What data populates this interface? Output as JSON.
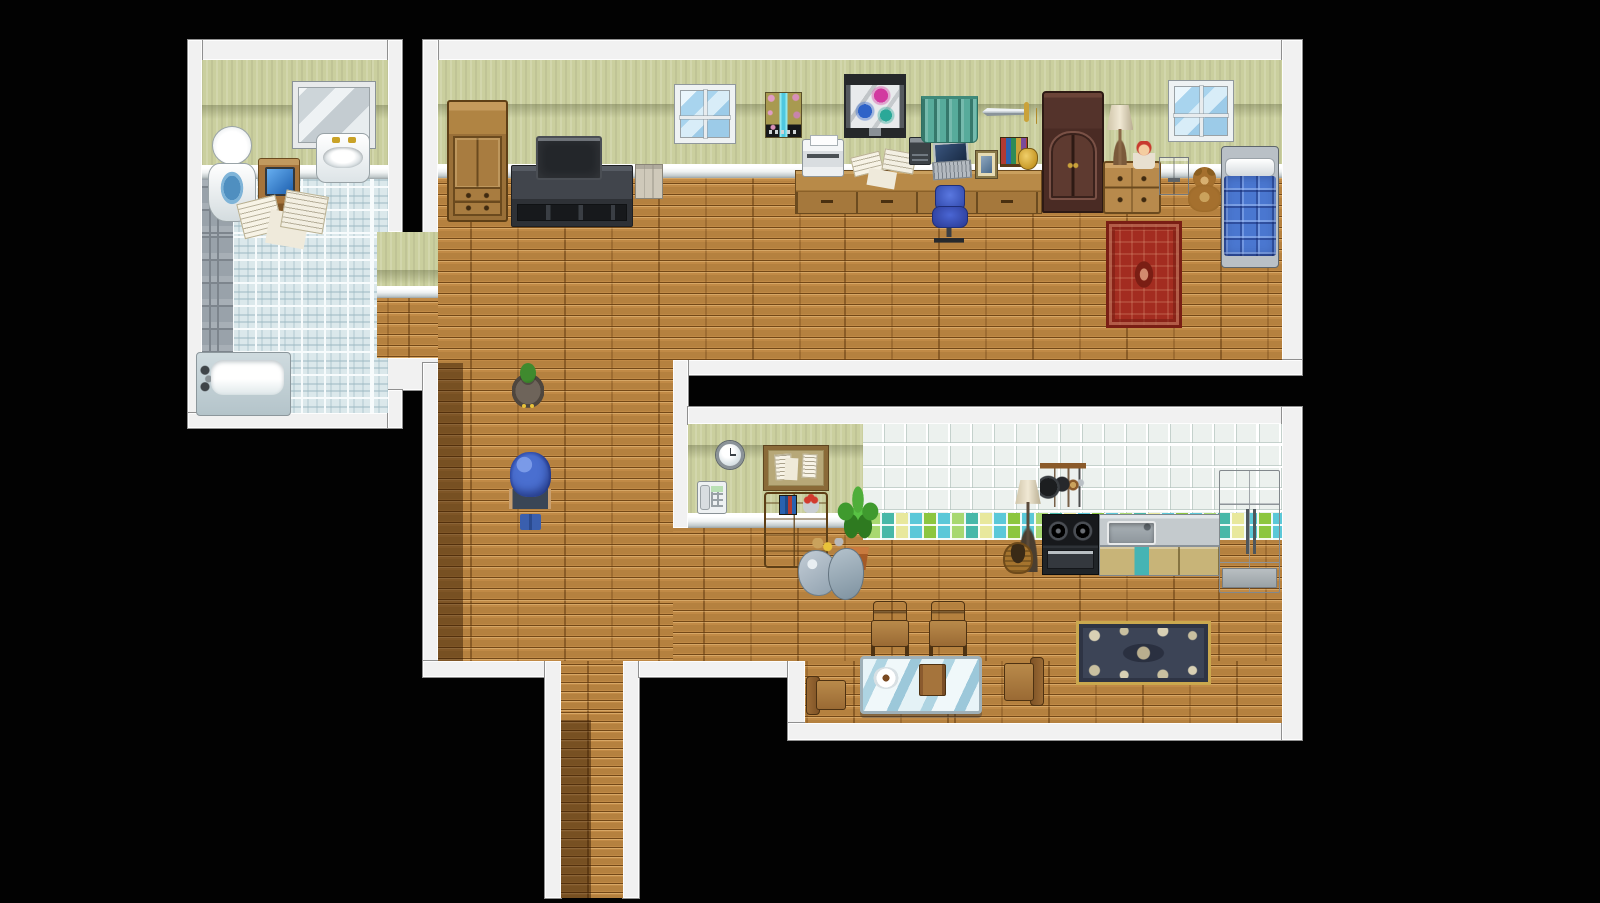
{
  "meta": {
    "app": "rpg-maker-style-game",
    "scene": "top-down house interior map",
    "viewport": {
      "width": 1600,
      "height": 903
    },
    "background_color": "#020202"
  },
  "palette": {
    "wall_border": "#f1f1f1",
    "wallpaper_green": "#cacf9e",
    "wood_floor": "#b5813f",
    "bathroom_tile": "#dbe8eb",
    "gray_tile": "#99a2aa",
    "kitchen_tile": "#ecf1ee",
    "quilt_blue": "#4a77d0",
    "rug_red": "#a32c20",
    "rug_dark": "#3c4456",
    "curtain_teal": "#57ab9b",
    "shadow": "rgba(45,20,0,0.45)"
  },
  "rooms": [
    {
      "name": "bathroom",
      "position": "top-left"
    },
    {
      "name": "bedroom-study",
      "position": "top"
    },
    {
      "name": "kitchen-dining",
      "position": "bottom-right"
    },
    {
      "name": "hallway",
      "position": "center-left"
    },
    {
      "name": "corridor-exit",
      "position": "bottom"
    }
  ],
  "map": {
    "borders": [
      {
        "name": "bathroom-wall-top",
        "x": 188,
        "y": 40,
        "w": 214,
        "h": 20
      },
      {
        "name": "bathroom-wall-left",
        "x": 188,
        "y": 40,
        "w": 14,
        "h": 388
      },
      {
        "name": "bathroom-wall-right-upper",
        "x": 388,
        "y": 40,
        "w": 14,
        "h": 192
      },
      {
        "name": "bathroom-wall-bottom",
        "x": 188,
        "y": 413,
        "w": 214,
        "h": 15
      },
      {
        "name": "bedroom-wall-top",
        "x": 423,
        "y": 40,
        "w": 879,
        "h": 20
      },
      {
        "name": "bedroom-wall-left-upper",
        "x": 423,
        "y": 40,
        "w": 15,
        "h": 258
      },
      {
        "name": "bedroom-wall-right",
        "x": 1282,
        "y": 40,
        "w": 20,
        "h": 335
      },
      {
        "name": "bedroom-wall-bottom",
        "x": 673,
        "y": 360,
        "w": 629,
        "h": 15
      },
      {
        "name": "kitchen-wall-left-cap",
        "x": 673,
        "y": 360,
        "w": 15,
        "h": 168
      },
      {
        "name": "passage-wall-band",
        "x": 380,
        "y": 358,
        "w": 60,
        "h": 32
      },
      {
        "name": "passage-wall-band-lower",
        "x": 388,
        "y": 390,
        "w": 14,
        "h": 38
      },
      {
        "name": "hallway-wall-left",
        "x": 423,
        "y": 363,
        "w": 15,
        "h": 314
      },
      {
        "name": "hallway-wall-bottom",
        "x": 423,
        "y": 661,
        "w": 122,
        "h": 16
      },
      {
        "name": "corridor-wall-left",
        "x": 545,
        "y": 661,
        "w": 16,
        "h": 237
      },
      {
        "name": "corridor-wall-right",
        "x": 623,
        "y": 661,
        "w": 16,
        "h": 237
      },
      {
        "name": "mid-wall-bottom-band",
        "x": 639,
        "y": 661,
        "w": 149,
        "h": 16
      },
      {
        "name": "kitchen-wall-left-lower",
        "x": 788,
        "y": 661,
        "w": 17,
        "h": 62
      },
      {
        "name": "kitchen-wall-bottom",
        "x": 788,
        "y": 723,
        "w": 514,
        "h": 17
      },
      {
        "name": "kitchen-wall-top",
        "x": 688,
        "y": 407,
        "w": 614,
        "h": 17
      },
      {
        "name": "kitchen-wall-right",
        "x": 1282,
        "y": 407,
        "w": 20,
        "h": 333
      }
    ],
    "surfaces": [
      {
        "name": "bathroom-wallpaper",
        "kind": "wallpaper",
        "x": 202,
        "y": 60,
        "w": 186,
        "h": 105
      },
      {
        "name": "bathroom-wall-trim",
        "kind": "trim",
        "x": 202,
        "y": 165,
        "w": 186,
        "h": 14
      },
      {
        "name": "bathroom-floor",
        "kind": "floor-tile",
        "x": 202,
        "y": 179,
        "w": 186,
        "h": 234
      },
      {
        "name": "bathroom-floor-gray-strip",
        "kind": "floor-gray",
        "x": 202,
        "y": 179,
        "w": 31,
        "h": 234
      },
      {
        "name": "passage-wallpaper",
        "kind": "wallpaper",
        "x": 377,
        "y": 232,
        "w": 68,
        "h": 54
      },
      {
        "name": "passage-wall-trim",
        "kind": "trim",
        "x": 377,
        "y": 286,
        "w": 68,
        "h": 12
      },
      {
        "name": "passage-floor",
        "kind": "floor-wood",
        "x": 377,
        "y": 298,
        "w": 68,
        "h": 60
      },
      {
        "name": "bedroom-wallpaper",
        "kind": "wallpaper",
        "x": 438,
        "y": 60,
        "w": 844,
        "h": 104
      },
      {
        "name": "bedroom-wall-trim",
        "kind": "trim",
        "x": 438,
        "y": 164,
        "w": 844,
        "h": 14
      },
      {
        "name": "bedroom-floor",
        "kind": "floor-wood",
        "x": 438,
        "y": 178,
        "w": 844,
        "h": 182
      },
      {
        "name": "hallway-floor",
        "kind": "floor-wood",
        "x": 438,
        "y": 360,
        "w": 235,
        "h": 301
      },
      {
        "name": "kitchen-wallpaper-green",
        "kind": "wallpaper",
        "x": 688,
        "y": 424,
        "w": 175,
        "h": 89
      },
      {
        "name": "kitchen-wall-tiles",
        "kind": "wall-tile",
        "x": 863,
        "y": 424,
        "w": 419,
        "h": 89
      },
      {
        "name": "kitchen-wall-trim",
        "kind": "trim",
        "x": 688,
        "y": 513,
        "w": 175,
        "h": 15
      },
      {
        "name": "kitchen-floor",
        "kind": "floor-wood",
        "x": 673,
        "y": 528,
        "w": 609,
        "h": 133
      },
      {
        "name": "kitchen-backsplash",
        "kind": "backsplash",
        "x": 863,
        "y": 513,
        "w": 419,
        "h": 27
      },
      {
        "name": "kitchen-floor-lower",
        "kind": "floor-wood",
        "x": 805,
        "y": 661,
        "w": 477,
        "h": 62
      },
      {
        "name": "corridor-floor",
        "kind": "floor-corridor",
        "x": 561,
        "y": 661,
        "w": 62,
        "h": 237
      }
    ],
    "shadows": [
      {
        "name": "hallway-wall-shadow",
        "x": 438,
        "y": 363,
        "w": 25,
        "h": 298
      },
      {
        "name": "corridor-wall-shadow",
        "x": 561,
        "y": 720,
        "w": 30,
        "h": 178
      }
    ],
    "furniture": [
      {
        "name": "bathroom-mirror",
        "kind": "mirror",
        "x": 293,
        "y": 82,
        "w": 82,
        "h": 66
      },
      {
        "name": "bathroom-sink",
        "kind": "sink",
        "x": 316,
        "y": 133,
        "w": 54,
        "h": 50
      },
      {
        "name": "toilet",
        "kind": "toilet",
        "x": 208,
        "y": 126,
        "w": 46,
        "h": 98
      },
      {
        "name": "bathroom-stand",
        "kind": "bath-stand",
        "x": 258,
        "y": 158,
        "w": 42,
        "h": 54
      },
      {
        "name": "scattered-magazines",
        "kind": "papers",
        "x": 240,
        "y": 193,
        "w": 90,
        "h": 58
      },
      {
        "name": "bathtub",
        "kind": "bathtub",
        "x": 196,
        "y": 352,
        "w": 95,
        "h": 64
      },
      {
        "name": "wardrobe",
        "kind": "wardrobe",
        "x": 447,
        "y": 100,
        "w": 61,
        "h": 122
      },
      {
        "name": "tv-stand",
        "kind": "tv-stand",
        "x": 511,
        "y": 165,
        "w": 122,
        "h": 62
      },
      {
        "name": "television",
        "kind": "tv",
        "x": 536,
        "y": 136,
        "w": 66,
        "h": 44
      },
      {
        "name": "file-organizer",
        "kind": "file-box",
        "x": 635,
        "y": 164,
        "w": 28,
        "h": 35
      },
      {
        "name": "window-bedroom-left",
        "kind": "window",
        "x": 675,
        "y": 85,
        "w": 60,
        "h": 58
      },
      {
        "name": "wall-poster",
        "kind": "poster",
        "x": 765,
        "y": 92,
        "w": 37,
        "h": 46
      },
      {
        "name": "study-desk",
        "kind": "desk",
        "x": 795,
        "y": 170,
        "w": 247,
        "h": 44
      },
      {
        "name": "printer",
        "kind": "printer",
        "x": 802,
        "y": 139,
        "w": 42,
        "h": 38
      },
      {
        "name": "scattered-papers-desk",
        "kind": "papers",
        "x": 852,
        "y": 151,
        "w": 66,
        "h": 31
      },
      {
        "name": "typewriter",
        "kind": "typewriter",
        "x": 909,
        "y": 137,
        "w": 22,
        "h": 28
      },
      {
        "name": "laptop",
        "kind": "laptop",
        "x": 932,
        "y": 142,
        "w": 39,
        "h": 39
      },
      {
        "name": "photo-frame",
        "kind": "photo-frame",
        "x": 976,
        "y": 151,
        "w": 21,
        "h": 27
      },
      {
        "name": "desk-books",
        "kind": "books",
        "x": 1000,
        "y": 137,
        "w": 28,
        "h": 30
      },
      {
        "name": "gold-jug",
        "kind": "gold-jug",
        "x": 1018,
        "y": 148,
        "w": 20,
        "h": 22
      },
      {
        "name": "butterfly-picture",
        "kind": "picture",
        "x": 846,
        "y": 76,
        "w": 58,
        "h": 60
      },
      {
        "name": "green-curtain",
        "kind": "curtain",
        "x": 921,
        "y": 96,
        "w": 57,
        "h": 47
      },
      {
        "name": "wall-sword",
        "kind": "sword",
        "x": 982,
        "y": 102,
        "w": 60,
        "h": 20
      },
      {
        "name": "dark-armoire",
        "kind": "armoire",
        "x": 1042,
        "y": 91,
        "w": 62,
        "h": 122
      },
      {
        "name": "dresser",
        "kind": "dresser",
        "x": 1103,
        "y": 161,
        "w": 58,
        "h": 53
      },
      {
        "name": "table-lamp",
        "kind": "table-lamp",
        "x": 1104,
        "y": 105,
        "w": 32,
        "h": 60
      },
      {
        "name": "red-haired-doll",
        "kind": "doll",
        "x": 1133,
        "y": 141,
        "w": 22,
        "h": 28
      },
      {
        "name": "gray-nightstand",
        "kind": "nightstand",
        "x": 1159,
        "y": 157,
        "w": 30,
        "h": 38
      },
      {
        "name": "teddy-bear",
        "kind": "teddy",
        "x": 1186,
        "y": 167,
        "w": 37,
        "h": 46
      },
      {
        "name": "window-bedroom-right",
        "kind": "window",
        "x": 1169,
        "y": 81,
        "w": 64,
        "h": 60
      },
      {
        "name": "blue-bed",
        "kind": "bed",
        "x": 1221,
        "y": 146,
        "w": 58,
        "h": 122
      },
      {
        "name": "red-rug",
        "kind": "rug-red",
        "x": 1106,
        "y": 221,
        "w": 76,
        "h": 107
      },
      {
        "name": "office-chair",
        "kind": "office-chair",
        "x": 929,
        "y": 185,
        "w": 40,
        "h": 58
      },
      {
        "name": "wall-clock",
        "kind": "clock",
        "x": 716,
        "y": 441,
        "w": 28,
        "h": 28
      },
      {
        "name": "wall-phone",
        "kind": "phone",
        "x": 697,
        "y": 481,
        "w": 30,
        "h": 33
      },
      {
        "name": "corkboard",
        "kind": "corkboard",
        "x": 764,
        "y": 446,
        "w": 64,
        "h": 44
      },
      {
        "name": "kitchen-bureau",
        "kind": "bureau",
        "x": 764,
        "y": 492,
        "w": 64,
        "h": 76
      },
      {
        "name": "potted-plant",
        "kind": "plant",
        "x": 836,
        "y": 480,
        "w": 44,
        "h": 90
      },
      {
        "name": "trash-bags",
        "kind": "trash",
        "x": 798,
        "y": 538,
        "w": 66,
        "h": 62
      },
      {
        "name": "floor-lamp",
        "kind": "floor-lamp",
        "x": 1012,
        "y": 480,
        "w": 32,
        "h": 92
      },
      {
        "name": "pot-rack",
        "kind": "pot-rack",
        "x": 1040,
        "y": 463,
        "w": 46,
        "h": 44
      },
      {
        "name": "basket-pot",
        "kind": "basket",
        "x": 1003,
        "y": 542,
        "w": 30,
        "h": 32
      },
      {
        "name": "stove",
        "kind": "stove",
        "x": 1042,
        "y": 514,
        "w": 57,
        "h": 61
      },
      {
        "name": "sink-counter",
        "kind": "counter",
        "x": 1099,
        "y": 514,
        "w": 121,
        "h": 62
      },
      {
        "name": "refrigerator",
        "kind": "fridge",
        "x": 1219,
        "y": 470,
        "w": 61,
        "h": 123
      },
      {
        "name": "ornate-dark-rug",
        "kind": "rug-dark",
        "x": 1076,
        "y": 621,
        "w": 135,
        "h": 64
      },
      {
        "name": "dining-chair-north-1",
        "kind": "chair-up",
        "x": 871,
        "y": 601,
        "w": 38,
        "h": 57
      },
      {
        "name": "dining-chair-north-2",
        "kind": "chair-up",
        "x": 929,
        "y": 601,
        "w": 38,
        "h": 57
      },
      {
        "name": "glass-dining-table",
        "kind": "glass-table",
        "x": 860,
        "y": 656,
        "w": 122,
        "h": 58
      },
      {
        "name": "dining-chair-west",
        "kind": "chair-side-right",
        "x": 806,
        "y": 674,
        "w": 40,
        "h": 44
      },
      {
        "name": "dining-chair-east",
        "kind": "chair-side-left",
        "x": 1004,
        "y": 655,
        "w": 40,
        "h": 56
      }
    ],
    "characters": [
      {
        "name": "npc-duck",
        "kind": "duck",
        "x": 512,
        "y": 363,
        "w": 32,
        "h": 45
      },
      {
        "name": "player-hero-blue-hair",
        "kind": "hero",
        "x": 508,
        "y": 452,
        "w": 45,
        "h": 78
      }
    ]
  }
}
